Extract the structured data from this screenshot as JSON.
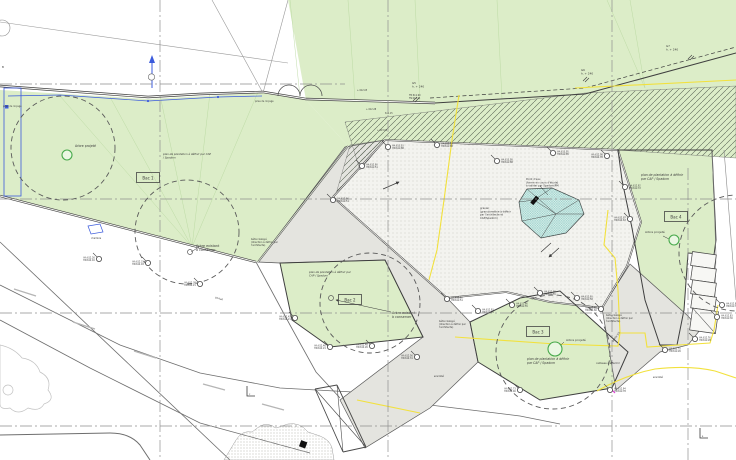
{
  "meta": {
    "drawing_type": "plan de plantation / aménagement paysager",
    "language": "fr"
  },
  "palette": {
    "green": "#dcedc8",
    "green_guide": "#b9d8a0",
    "hatch_line": "#55604f",
    "gray_path": "#e4e4df",
    "gravel": "#f3f3ef",
    "stipple": "#c2c2b8",
    "wall": "#3f3f3f",
    "road": "#6e6e6e",
    "lane_dash": "#b5b5b5",
    "water_fill": "#d8efeb",
    "water_line": "#63b4ab",
    "yellow": "#f2e13d",
    "blue": "#3b5bdc",
    "magenta": "#e23bd9",
    "tree_dash": "#5a5a5a",
    "tree_green": "#47a94b",
    "grid": "#8f8f8f",
    "text": "#3a3a3a"
  },
  "planters": [
    {
      "label": "Bac 1",
      "x": 148,
      "y": 178
    },
    {
      "label": "Bac 2",
      "x": 350,
      "y": 300
    },
    {
      "label": "Bac 3",
      "x": 538,
      "y": 332
    },
    {
      "label": "Bac 4",
      "x": 676,
      "y": 217
    }
  ],
  "labels": [
    {
      "x": 75,
      "y": 147,
      "sz": 3.2,
      "lines": [
        "Arbre projeté"
      ]
    },
    {
      "x": 163,
      "y": 155,
      "sz": 2.7,
      "it": 1,
      "lines": [
        "plan de plantation à définir par CAP",
        "/ Spadom"
      ]
    },
    {
      "x": 196,
      "y": 247,
      "sz": 3.3,
      "lines": [
        "Arbre existant",
        "à conserver"
      ]
    },
    {
      "x": 309,
      "y": 273,
      "sz": 2.7,
      "it": 1,
      "lines": [
        "plan de plantation à définir par",
        "CAP / Spadom"
      ]
    },
    {
      "x": 392,
      "y": 314,
      "sz": 3.3,
      "lines": [
        "Arbre existant",
        "à conserver"
      ]
    },
    {
      "x": 527,
      "y": 360,
      "sz": 3.1,
      "it": 1,
      "lines": [
        "plan de plantation à définir",
        "par CAP / Spadom"
      ]
    },
    {
      "x": 566,
      "y": 341,
      "sz": 3.0,
      "lines": [
        "Arbre projeté"
      ]
    },
    {
      "x": 641,
      "y": 176,
      "sz": 3.1,
      "it": 1,
      "lines": [
        "plan de plantation à définir",
        "par CAP / Spadom"
      ]
    },
    {
      "x": 645,
      "y": 233,
      "sz": 3.0,
      "lines": [
        "Arbre projeté"
      ]
    },
    {
      "x": 526,
      "y": 180,
      "sz": 2.6,
      "lines": [
        "Point d'eau",
        "(forme en cours d'étude)",
        "à valider par Spadom/PM"
      ]
    },
    {
      "x": 480,
      "y": 209,
      "sz": 2.6,
      "lines": [
        "gravier",
        "(granulométrie à définir",
        "par l'architecte et",
        "CAP/Spadom)"
      ]
    },
    {
      "x": 251,
      "y": 240,
      "sz": 2.4,
      "lines": [
        "béton balayé",
        "(direction à définir par",
        "l'architecte)"
      ]
    },
    {
      "x": 439,
      "y": 322,
      "sz": 2.4,
      "lines": [
        "béton balayé",
        "(direction à définir par",
        "l'architecte)"
      ]
    },
    {
      "x": 606,
      "y": 316,
      "sz": 2.4,
      "lines": [
        "béton balayé",
        "(direction à définir par",
        "l'architecte)"
      ]
    },
    {
      "x": 596,
      "y": 364,
      "sz": 2.5,
      "lines": [
        "caillasse à affermir"
      ]
    },
    {
      "x": 434,
      "y": 377,
      "sz": 2.8,
      "it": 1,
      "lines": [
        "enrobé"
      ]
    },
    {
      "x": 653,
      "y": 378,
      "sz": 2.8,
      "it": 1,
      "lines": [
        "enrobé"
      ]
    },
    {
      "x": 215,
      "y": 298,
      "sz": 2.5,
      "rot": 18,
      "lines": [
        "portail"
      ]
    },
    {
      "x": 613,
      "y": 342,
      "sz": 2.5,
      "rot": -52,
      "lines": [
        "pente 5%"
      ]
    },
    {
      "x": 412,
      "y": 84,
      "sz": 2.8,
      "lines": [
        "G5",
        "h. + 240"
      ]
    },
    {
      "x": 581,
      "y": 71,
      "sz": 2.8,
      "lines": [
        "G6",
        "h. + 240"
      ]
    },
    {
      "x": 666,
      "y": 47,
      "sz": 2.8,
      "lines": [
        "G7",
        "h. + 240"
      ]
    },
    {
      "x": 409,
      "y": 96,
      "sz": 2.2,
      "lines": [
        "TM 611.90",
        "TN 611.75"
      ]
    },
    {
      "x": 357,
      "y": 91,
      "sz": 2.2,
      "lines": [
        "+ 612.05"
      ]
    },
    {
      "x": 366,
      "y": 110,
      "sz": 2.2,
      "lines": [
        "+ 612.28"
      ]
    },
    {
      "x": 385,
      "y": 114,
      "sz": 2.2,
      "lines": [
        "612.15"
      ]
    },
    {
      "x": 377,
      "y": 131,
      "sz": 2.2,
      "lines": [
        "+ 613.05"
      ]
    },
    {
      "x": 3,
      "y": 107,
      "sz": 2.3,
      "col": "blue",
      "lines": [
        "prise de rinçage"
      ]
    },
    {
      "x": 255,
      "y": 102,
      "sz": 2.3,
      "col": "blue",
      "lines": [
        "prise de rinçage"
      ]
    },
    {
      "x": 91,
      "y": 239,
      "sz": 2.3,
      "col": "blue",
      "lines": [
        "chambre"
      ]
    },
    {
      "x": 2,
      "y": 68,
      "sz": 2.8,
      "lines": [
        "B"
      ]
    },
    {
      "x": 249,
      "y": 395,
      "sz": 2.4,
      "lines": [
        "c"
      ]
    },
    {
      "x": 702,
      "y": 437,
      "sz": 2.4,
      "lines": [
        "s"
      ]
    }
  ],
  "markers": [
    {
      "x": 99,
      "y": 259,
      "s": "l",
      "a": "HA 612.26",
      "b": "HN 612.16"
    },
    {
      "x": 148,
      "y": 263,
      "s": "l",
      "a": "HA 612.31",
      "b": "HN 612.18"
    },
    {
      "x": 200,
      "y": 284,
      "s": "l",
      "a": "HA 612.38",
      "b": "HN 612.21"
    },
    {
      "x": 295,
      "y": 318,
      "s": "l",
      "a": "HA 612.43",
      "b": "HN 612.21"
    },
    {
      "x": 330,
      "y": 347,
      "s": "l",
      "a": "HA 612.46",
      "b": "HN 612.21"
    },
    {
      "x": 372,
      "y": 346,
      "s": "l",
      "a": "HA 612.48",
      "b": "HN 612.26"
    },
    {
      "x": 417,
      "y": 357,
      "s": "l",
      "a": "HA 612.56",
      "b": "HN 612.31"
    },
    {
      "x": 333,
      "y": 200,
      "s": "r",
      "a": "HA 612.96",
      "b": "HN 612.51"
    },
    {
      "x": 362,
      "y": 166,
      "s": "r",
      "a": "HA 612.90",
      "b": "HN 612.51"
    },
    {
      "x": 388,
      "y": 147,
      "s": "r",
      "a": "HA 613.03",
      "b": "HN 612.88"
    },
    {
      "x": 437,
      "y": 145,
      "s": "r",
      "a": "HA 613.08",
      "b": "HN 612.88"
    },
    {
      "x": 497,
      "y": 161,
      "s": "r",
      "a": "HA 613.08",
      "b": "HN 612.88"
    },
    {
      "x": 553,
      "y": 153,
      "s": "r",
      "a": "HA 613.05",
      "b": "HN 612.85"
    },
    {
      "x": 607,
      "y": 156,
      "s": "l",
      "a": "HA 612.98",
      "b": "HN 612.78"
    },
    {
      "x": 625,
      "y": 187,
      "s": "r",
      "a": "HA 612.92",
      "b": "HN 612.72"
    },
    {
      "x": 630,
      "y": 219,
      "s": "l",
      "a": "HA 612.87",
      "b": "HN 612.63"
    },
    {
      "x": 447,
      "y": 299,
      "s": "r",
      "a": "HA 612.90",
      "b": "HN 612.51"
    },
    {
      "x": 478,
      "y": 311,
      "s": "r",
      "a": "HA 612.93",
      "b": "HN 612.55"
    },
    {
      "x": 512,
      "y": 305,
      "s": "r",
      "a": "HA 612.96",
      "b": "HN 612.55"
    },
    {
      "x": 540,
      "y": 293,
      "s": "r",
      "a": "HA 612.98",
      "b": "HN 612.55"
    },
    {
      "x": 577,
      "y": 298,
      "s": "r",
      "a": "HA 612.90",
      "b": "HN 612.58"
    },
    {
      "x": 601,
      "y": 309,
      "s": "l",
      "a": "HA 612.88",
      "b": "HN 612.60"
    },
    {
      "x": 520,
      "y": 390,
      "s": "l",
      "a": "HA 612.73",
      "b": "HN 612.46"
    },
    {
      "x": 610,
      "y": 390,
      "s": "r",
      "a": "HA 612.94",
      "b": "HN 612.78"
    },
    {
      "x": 722,
      "y": 305,
      "s": "r",
      "a": "HA 612.87",
      "b": "HN 612.33"
    },
    {
      "x": 717,
      "y": 317,
      "s": "r",
      "a": "HA 612.83",
      "b": "HN 612.30"
    },
    {
      "x": 695,
      "y": 339,
      "s": "r",
      "a": "HA 612.76",
      "b": "HN 612.28"
    },
    {
      "x": 665,
      "y": 350,
      "s": "r",
      "a": "HA 612.70",
      "b": "HN 612.26"
    }
  ],
  "trees": {
    "existing": [
      {
        "cx": 63,
        "cy": 148,
        "r": 52
      },
      {
        "cx": 187,
        "cy": 232,
        "r": 52
      },
      {
        "cx": 370,
        "cy": 303,
        "r": 50
      },
      {
        "cx": 553,
        "cy": 352,
        "r": 57
      },
      {
        "cx": 737,
        "cy": 253,
        "r": 58
      }
    ],
    "projected": [
      {
        "cx": 67,
        "cy": 155,
        "r": 5
      },
      {
        "cx": 555,
        "cy": 349,
        "r": 7
      },
      {
        "cx": 674,
        "cy": 240,
        "r": 5
      }
    ],
    "trunks": [
      {
        "cx": 190,
        "cy": 252
      },
      {
        "cx": 331,
        "cy": 298
      }
    ]
  },
  "grid": {
    "vertical": [
      {
        "x": 160,
        "y1": 0,
        "y2": 460
      },
      {
        "x": 388,
        "y1": 0,
        "y2": 460
      },
      {
        "x": 612,
        "y1": 0,
        "y2": 460
      },
      {
        "x": 688,
        "y1": 168,
        "y2": 460
      }
    ],
    "horizontal": [
      {
        "y": 84,
        "x1": 0,
        "x2": 345
      },
      {
        "y": 199,
        "x1": 0,
        "x2": 736
      },
      {
        "y": 313,
        "x1": 0,
        "x2": 736
      },
      {
        "y": 426,
        "x1": 0,
        "x2": 736
      }
    ]
  }
}
